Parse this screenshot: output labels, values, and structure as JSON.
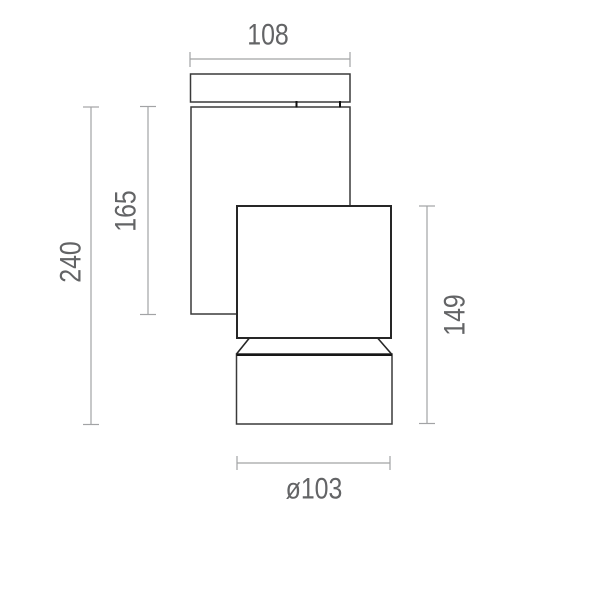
{
  "drawing": {
    "kind": "technical-dimension-drawing",
    "subject": "wall-mounted-spotlight-side-view",
    "labels": {
      "plate_width": "108",
      "body_height": "165",
      "total_height": "240",
      "head_height": "149",
      "diameter": "ø103"
    },
    "colors": {
      "background": "#ffffff",
      "fixture_outline": "#333333",
      "dimension_lines": "#a2a3a5",
      "dimension_text": "#636466"
    }
  }
}
